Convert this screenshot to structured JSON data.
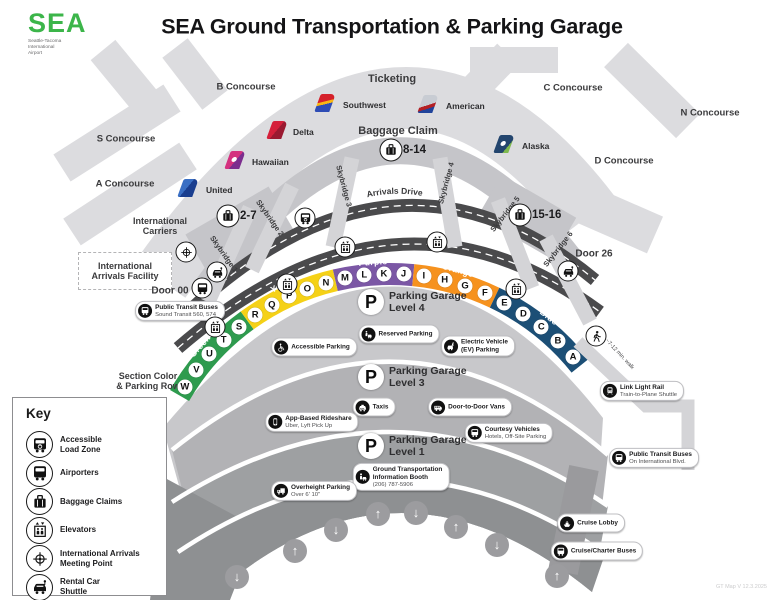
{
  "header": {
    "logo_text": "SEA",
    "logo_sub": "Seattle-Tacoma\nInternational\nAirport",
    "title": "SEA Ground Transportation & Parking Garage"
  },
  "concourses": [
    {
      "id": "b",
      "label": "B Concourse"
    },
    {
      "id": "s",
      "label": "S Concourse"
    },
    {
      "id": "a",
      "label": "A Concourse"
    },
    {
      "id": "c",
      "label": "C Concourse"
    },
    {
      "id": "n",
      "label": "N Concourse"
    },
    {
      "id": "d",
      "label": "D Concourse"
    }
  ],
  "terminal": {
    "ticketing": "Ticketing",
    "baggage_claim": "Baggage Claim",
    "arrivals_drive": "Arrivals Drive",
    "intl_carriers": "International\nCarriers",
    "intl_arrivals_facility": "International\nArrivals Facility",
    "door00": "Door 00",
    "door26": "Door 26"
  },
  "airlines": [
    {
      "name": "Southwest",
      "tail_css": "linear-gradient(165deg,#d5202a 42%,#f9b612 42%,#f9b612 56%,#2e4cb5 56%)",
      "dot": false
    },
    {
      "name": "American",
      "tail_css": "linear-gradient(160deg,#c8ccd3 55%,#b42025 55%,#b42025 72%,#21449b 72%)",
      "dot": false
    },
    {
      "name": "Delta",
      "tail_css": "linear-gradient(115deg,#d5203b 50%,#9a1a31 50%)",
      "dot": false
    },
    {
      "name": "Hawaiian",
      "tail_css": "linear-gradient(115deg,#d4317f 55%,#7c2d8e 55%)",
      "dot": true
    },
    {
      "name": "United",
      "tail_css": "linear-gradient(115deg,#3a6fc4 45%,#1a3e8f 45%)",
      "dot": false
    },
    {
      "name": "Alaska",
      "tail_css": "linear-gradient(115deg,#23456e 75%,#7fb94e 75%)",
      "dot": true
    }
  ],
  "skybridges": [
    "Skybridge 1",
    "Skybridge 2",
    "Skybridge 3",
    "Skybridge 4",
    "Skybridge 5",
    "Skybridge 6"
  ],
  "baggage_claims": [
    {
      "range": "2-7"
    },
    {
      "range": "8-14"
    },
    {
      "range": "15-16"
    }
  ],
  "parking": {
    "section_note": "Section Color\n& Parking Row",
    "sections": [
      {
        "name": "Green",
        "color": "#2E9B4E",
        "letters": [
          "W",
          "V",
          "U",
          "T",
          "S"
        ]
      },
      {
        "name": "Yellow",
        "color": "#F5D117",
        "letters": [
          "R",
          "Q",
          "P",
          "O",
          "N"
        ]
      },
      {
        "name": "Purple",
        "color": "#7B57A5",
        "letters": [
          "M",
          "L",
          "K",
          "J"
        ]
      },
      {
        "name": "Orange",
        "color": "#F6921E",
        "letters": [
          "I",
          "H",
          "G",
          "F"
        ]
      },
      {
        "name": "Blue",
        "color": "#1C4F76",
        "letters": [
          "E",
          "D",
          "C",
          "B",
          "A"
        ]
      }
    ],
    "levels": [
      {
        "line1": "Parking Garage",
        "line2": "Level 4"
      },
      {
        "line1": "Parking Garage",
        "line2": "Level 3"
      },
      {
        "line1": "Parking Garage",
        "line2": "Level 1"
      }
    ]
  },
  "pills": [
    {
      "id": "public-transit-sound",
      "icon": "bus",
      "bold_lines": 1,
      "lines": [
        "Public Transit Buses",
        "Sound Transit 560, 574"
      ]
    },
    {
      "id": "accessible-parking",
      "icon": "wheelchair",
      "bold_lines": 1,
      "lines": [
        "Accessible Parking"
      ]
    },
    {
      "id": "reserved-parking",
      "icon": "reserved",
      "bold_lines": 1,
      "lines": [
        "Reserved Parking"
      ]
    },
    {
      "id": "ev-parking",
      "icon": "ev",
      "bold_lines": 2,
      "lines": [
        "Electric Vehicle",
        "(EV) Parking"
      ]
    },
    {
      "id": "taxis",
      "icon": "taxi",
      "bold_lines": 1,
      "lines": [
        "Taxis"
      ]
    },
    {
      "id": "door-to-door-vans",
      "icon": "van",
      "bold_lines": 1,
      "lines": [
        "Door-to-Door Vans"
      ]
    },
    {
      "id": "app-based-rideshare",
      "icon": "phone",
      "bold_lines": 1,
      "lines": [
        "App-Based Rideshare",
        "Uber, Lyft Pick Up"
      ]
    },
    {
      "id": "courtesy-vehicles",
      "icon": "bus",
      "bold_lines": 1,
      "lines": [
        "Courtesy Vehicles",
        "Hotels, Off-Site Parking"
      ]
    },
    {
      "id": "ground-transportation-info-booth",
      "icon": "info",
      "bold_lines": 2,
      "lines": [
        "Ground Transportation",
        "Information Booth",
        "(206) 787-5906"
      ]
    },
    {
      "id": "overheight-parking",
      "icon": "truck",
      "bold_lines": 1,
      "lines": [
        "Overheight Parking",
        "Over 6' 10\""
      ]
    },
    {
      "id": "link-light-rail",
      "icon": "train",
      "bold_lines": 1,
      "lines": [
        "Link Light Rail",
        "Train-to-Plane Shuttle"
      ]
    },
    {
      "id": "public-transit-blvd",
      "icon": "bus",
      "bold_lines": 1,
      "lines": [
        "Public Transit Buses",
        "On International Blvd."
      ]
    },
    {
      "id": "cruise-lobby",
      "icon": "ship",
      "bold_lines": 1,
      "lines": [
        "Cruise Lobby"
      ]
    },
    {
      "id": "cruise-charter-buses",
      "icon": "bus",
      "bold_lines": 1,
      "lines": [
        "Cruise/Charter Buses"
      ]
    }
  ],
  "walk_note": "~7-12 min. walk",
  "key": {
    "title": "Key",
    "items": [
      {
        "icon": "accessible-bus",
        "label": "Accessible\nLoad Zone"
      },
      {
        "icon": "bus",
        "label": "Airporters"
      },
      {
        "icon": "suitcase",
        "label": "Baggage Claims"
      },
      {
        "icon": "elevator",
        "label": "Elevators"
      },
      {
        "icon": "crosshair",
        "label": "International Arrivals\nMeeting Point"
      },
      {
        "icon": "car-key",
        "label": "Rental Car\nShuttle"
      }
    ]
  },
  "arrows": [
    "down",
    "up",
    "down",
    "up",
    "down",
    "up",
    "down",
    "up"
  ],
  "version_note": "GT Map V 12.3.2025",
  "colors": {
    "road": "#4A4A4C",
    "terminal": "#DCDCDF",
    "terminal_mid": "#C5C5C9",
    "skybridge": "#D4D4D7",
    "garage_l4": "#C8C8CB",
    "garage_l3": "#B2B2B5",
    "garage_l1": "#9EA0A2",
    "garage_bottom": "#8E9092",
    "logo_green": "#3CB54A"
  }
}
